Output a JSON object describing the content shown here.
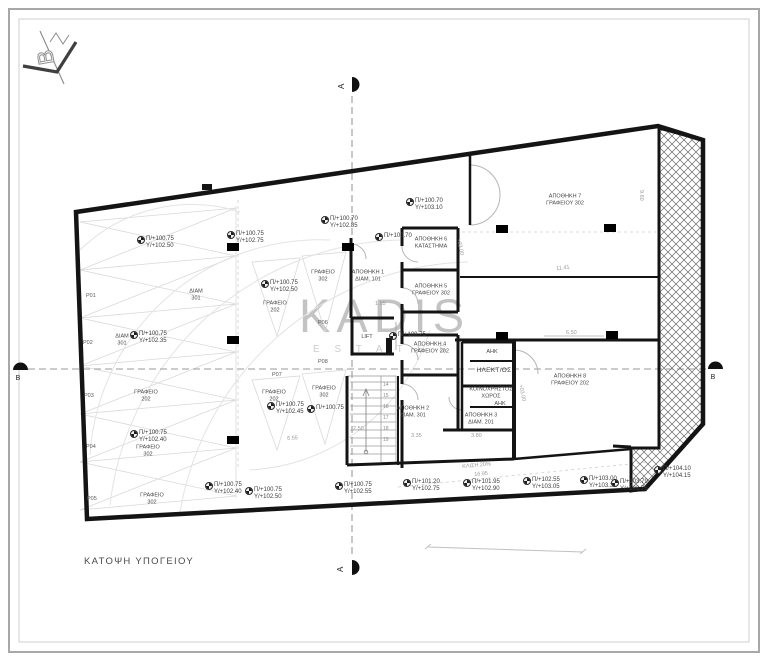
{
  "title": "ΚΑΤΟΨΗ ΥΠΟΓΕΙΟΥ",
  "watermark": {
    "main": "KADIS",
    "sub": "E S T A T E S"
  },
  "logo": {
    "letter": "B"
  },
  "section_markers": {
    "top": "A",
    "bottom": "A",
    "left": "B",
    "right": "B"
  },
  "colors": {
    "wall": "#141414",
    "construction": "#d9d9d9",
    "text": "#3c3c3c",
    "watermark": "#b5b5b5"
  },
  "elevation_labels": [
    {
      "x": 138,
      "y": 236,
      "a": "Π/+100.75",
      "b": "Y/+102.50"
    },
    {
      "x": 228,
      "y": 231,
      "a": "Π/+100.75",
      "b": "Y/+102.75"
    },
    {
      "x": 322,
      "y": 216,
      "a": "Π/+100.70",
      "b": "Y/+102.85"
    },
    {
      "x": 262,
      "y": 280,
      "a": "Π/+100.75",
      "b": "Y/+102.50"
    },
    {
      "x": 131,
      "y": 331,
      "a": "Π/+100.75",
      "b": "Y/+102.35"
    },
    {
      "x": 131,
      "y": 430,
      "a": "Π/+100.75",
      "b": "Y/+102.40"
    },
    {
      "x": 268,
      "y": 402,
      "a": "Π/+100.75",
      "b": "Y/+102.45"
    },
    {
      "x": 308,
      "y": 405,
      "a": "Π/+100.75",
      "b": ""
    },
    {
      "x": 407,
      "y": 198,
      "a": "Π/+100.70",
      "b": "Y/+103.10"
    },
    {
      "x": 376,
      "y": 233,
      "a": "Π/+100.70",
      "b": ""
    },
    {
      "x": 390,
      "y": 332,
      "a": "Π/+100.75",
      "b": ""
    },
    {
      "x": 206,
      "y": 482,
      "a": "Π/+100.75",
      "b": "Y/+102.40"
    },
    {
      "x": 246,
      "y": 487,
      "a": "Π/+100.75",
      "b": "Y/+102.50"
    },
    {
      "x": 336,
      "y": 482,
      "a": "Π/+100.75",
      "b": "Y/+102.55"
    },
    {
      "x": 404,
      "y": 479,
      "a": "Π/+101.20",
      "b": "Y/+102.75"
    },
    {
      "x": 464,
      "y": 479,
      "a": "Π/+101.95",
      "b": "Y/+102.90"
    },
    {
      "x": 524,
      "y": 477,
      "a": "Π/+102.55",
      "b": "Y/+103.05"
    },
    {
      "x": 581,
      "y": 476,
      "a": "Π/+103.00",
      "b": "Y/+103.30"
    },
    {
      "x": 612,
      "y": 479,
      "a": "Π/+103.79",
      "b": "Y/+103.75"
    },
    {
      "x": 655,
      "y": 466,
      "a": "Π/+104.10",
      "b": "Y/+104.15"
    }
  ],
  "room_labels": [
    {
      "x": 368,
      "y": 276,
      "big": false,
      "lines": [
        "ΑΠΟΘΗΚΗ 1",
        "ΔΙΑΜ. 101"
      ]
    },
    {
      "x": 367,
      "y": 337,
      "big": false,
      "lines": [
        "LIFT"
      ]
    },
    {
      "x": 431,
      "y": 243,
      "big": false,
      "lines": [
        "ΑΠΟΘΗΚΗ 6",
        "ΚΑΤΑΣΤΗΜΑ"
      ]
    },
    {
      "x": 431,
      "y": 290,
      "big": false,
      "lines": [
        "ΑΠΟΘΗΚΗ 5",
        "ΓΡΑΦΕΙΟΥ 302"
      ]
    },
    {
      "x": 430,
      "y": 348,
      "big": false,
      "lines": [
        "ΑΠΟΘΗΚΗ 4",
        "ΓΡΑΦΕΙΟΥ 202"
      ]
    },
    {
      "x": 413,
      "y": 412,
      "big": false,
      "lines": [
        "ΑΠΟΘΗΚΗ 2",
        "ΔΙΑΜ. 301"
      ]
    },
    {
      "x": 481,
      "y": 419,
      "big": false,
      "lines": [
        "ΑΠΟΘΗΚΗ 3",
        "ΔΙΑΜ. 201"
      ]
    },
    {
      "x": 565,
      "y": 200,
      "big": false,
      "lines": [
        "ΑΠΟΘΗΚΗ 7",
        "ΓΡΑΦΕΙΟΥ 302"
      ]
    },
    {
      "x": 570,
      "y": 380,
      "big": false,
      "lines": [
        "ΑΠΟΘΗΚΗ 8",
        "ΓΡΑΦΕΙΟΥ 202"
      ]
    },
    {
      "x": 492,
      "y": 352,
      "big": false,
      "lines": [
        "ΑΗΚ"
      ]
    },
    {
      "x": 494,
      "y": 371,
      "big": true,
      "lines": [
        "ΗΛΕΚΤ/ΟΣ"
      ]
    },
    {
      "x": 491,
      "y": 393,
      "big": false,
      "lines": [
        "ΚΟΙΝΟΧΡΗΣΤΟΣ",
        "ΧΩΡΟΣ"
      ]
    },
    {
      "x": 500,
      "y": 404,
      "big": false,
      "lines": [
        "ΑΗΚ"
      ]
    },
    {
      "x": 196,
      "y": 295,
      "big": false,
      "lines": [
        "ΔΙΑΜ",
        "301"
      ]
    },
    {
      "x": 122,
      "y": 340,
      "big": false,
      "lines": [
        "ΔΙΑΜ",
        "301"
      ]
    },
    {
      "x": 146,
      "y": 396,
      "big": false,
      "lines": [
        "ΓΡΑΦΕΙΟ",
        "202"
      ]
    },
    {
      "x": 148,
      "y": 451,
      "big": false,
      "lines": [
        "ΓΡΑΦΕΙΟ",
        "302"
      ]
    },
    {
      "x": 152,
      "y": 499,
      "big": false,
      "lines": [
        "ΓΡΑΦΕΙΟ",
        "302"
      ]
    },
    {
      "x": 275,
      "y": 307,
      "big": false,
      "lines": [
        "ΓΡΑΦΕΙΟ",
        "202"
      ]
    },
    {
      "x": 323,
      "y": 276,
      "big": false,
      "lines": [
        "ΓΡΑΦΕΙΟ",
        "302"
      ]
    },
    {
      "x": 274,
      "y": 396,
      "big": false,
      "lines": [
        "ΓΡΑΦΕΙΟ",
        "202"
      ]
    },
    {
      "x": 324,
      "y": 392,
      "big": false,
      "lines": [
        "ΓΡΑΦΕΙΟ",
        "302"
      ]
    }
  ],
  "parking_labels": [
    {
      "x": 86,
      "y": 293,
      "t": "P01"
    },
    {
      "x": 83,
      "y": 340,
      "t": "P02"
    },
    {
      "x": 84,
      "y": 393,
      "t": "P03"
    },
    {
      "x": 86,
      "y": 444,
      "t": "P04"
    },
    {
      "x": 87,
      "y": 496,
      "t": "P05"
    },
    {
      "x": 318,
      "y": 320,
      "t": "P06"
    },
    {
      "x": 272,
      "y": 372,
      "t": "P07"
    },
    {
      "x": 318,
      "y": 359,
      "t": "P08"
    }
  ],
  "dimensions": [
    {
      "x": 556,
      "y": 266,
      "t": "11.41",
      "r": -6
    },
    {
      "x": 471,
      "y": 433,
      "t": "3.80",
      "r": 0
    },
    {
      "x": 411,
      "y": 433,
      "t": "3.35",
      "r": 0
    },
    {
      "x": 353,
      "y": 426,
      "t": "2.50",
      "r": 0
    },
    {
      "x": 287,
      "y": 436,
      "t": "6.55",
      "r": -4
    },
    {
      "x": 644,
      "y": 190,
      "t": "9.60",
      "r": 90
    },
    {
      "x": 566,
      "y": 330,
      "t": "6.50",
      "r": 0
    },
    {
      "x": 375,
      "y": 301,
      "t": "1.55",
      "r": 0
    },
    {
      "x": 474,
      "y": 472,
      "t": "16.95",
      "r": -5
    },
    {
      "x": 461,
      "y": 238,
      "t": "+03.00",
      "r": 78
    },
    {
      "x": 523,
      "y": 384,
      "t": "+03.00",
      "r": 78
    },
    {
      "x": 462,
      "y": 464,
      "t": "ΚΛΙΣΗ 20%",
      "r": -5
    }
  ],
  "stair_numbers": [
    "14",
    "15",
    "16",
    "17",
    "18",
    "19"
  ]
}
